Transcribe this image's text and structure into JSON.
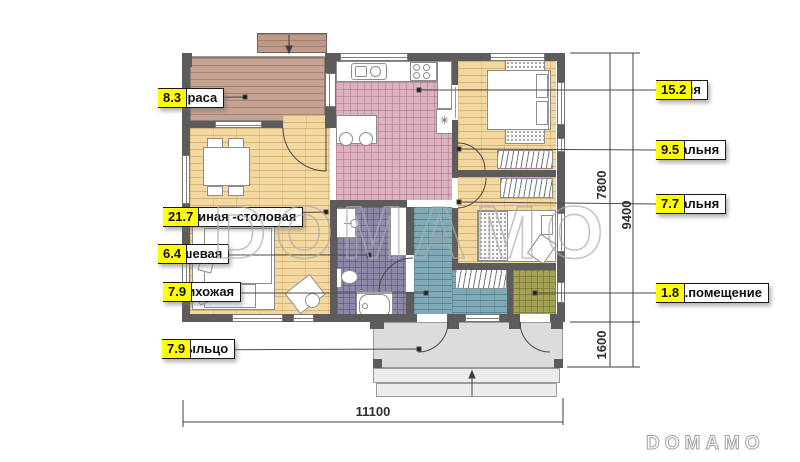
{
  "watermark": {
    "center": "DOMAMO",
    "corner": "DOMAMO"
  },
  "rooms_left": [
    {
      "name": "Терраса",
      "area": "8.3"
    },
    {
      "name": "Гостиная -столовая",
      "area": "21.7"
    },
    {
      "name": "Душевая",
      "area": "6.4"
    },
    {
      "name": "Прихожая",
      "area": "7.9"
    },
    {
      "name": "Крыльцо",
      "area": "7.9"
    }
  ],
  "rooms_right": [
    {
      "name": "Кухня",
      "area": "15.2"
    },
    {
      "name": "Спальня",
      "area": "9.5"
    },
    {
      "name": "Спальня",
      "area": "7.7"
    },
    {
      "name": "Тех.помещение",
      "area": "1.8"
    }
  ],
  "dimensions": {
    "house_depth": "7800",
    "total_depth": "9400",
    "porch_depth": "1600",
    "total_width": "11100"
  },
  "symbols": {
    "fridge": "✳"
  },
  "colors": {
    "wall": "#5d5b5c",
    "label_value_bg": "#ffff00",
    "terrace_deck": "#c6a292",
    "wood_floor": "#f3d8a1",
    "kitchen_tile": "#dcb2c0",
    "hall_tile": "#7fa9b4",
    "shower_tile": "#8c88a7",
    "tech_tile": "#a3a257",
    "porch": "#dcdcdc"
  }
}
